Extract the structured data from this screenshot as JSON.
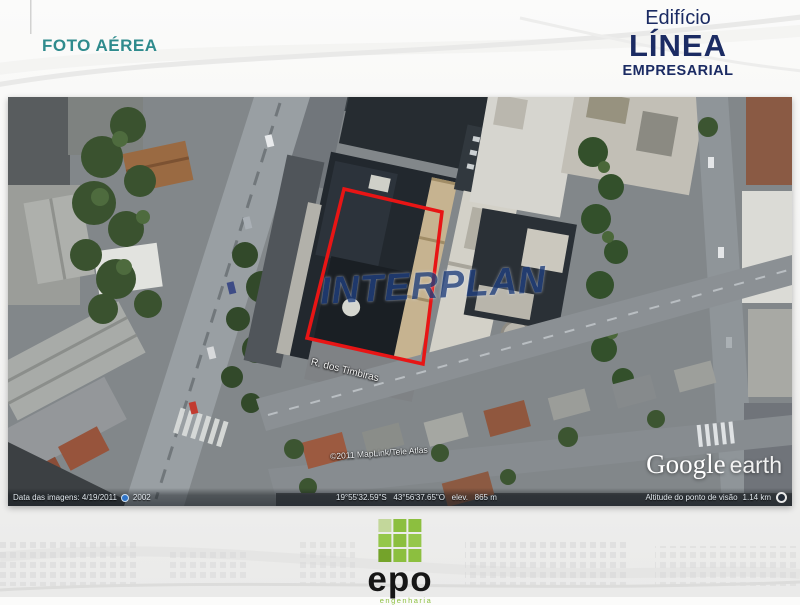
{
  "header": {
    "page_title": "FOTO AÉREA",
    "brand_line1": "Edifício",
    "brand_line2": "LÍNEA",
    "brand_line3": "EMPRESARIAL"
  },
  "map": {
    "watermark": "INTERPLAN",
    "street_label": "R. dos Timbiras",
    "copyright": "©2011 MapLink/Tele Atlas",
    "google_logo": "Google",
    "earth_logo": "earth",
    "status": {
      "imagery_date": "Data das imagens: 4/19/2011",
      "year_badge": "2002",
      "coordinates": "19°55'32.59\"S   43°56'37.65\"O   elev.   865 m",
      "eye_alt_label": "Altitude do ponto de visão",
      "eye_alt_value": "1.14 km"
    }
  },
  "footer": {
    "logo_name": "epo",
    "logo_tagline": "engenharia"
  },
  "colors": {
    "title_teal": "#2F8B8D",
    "brand_navy": "#1B2B63",
    "plot_outline_red": "#E81515",
    "logo_green": "#8CBF3F"
  }
}
